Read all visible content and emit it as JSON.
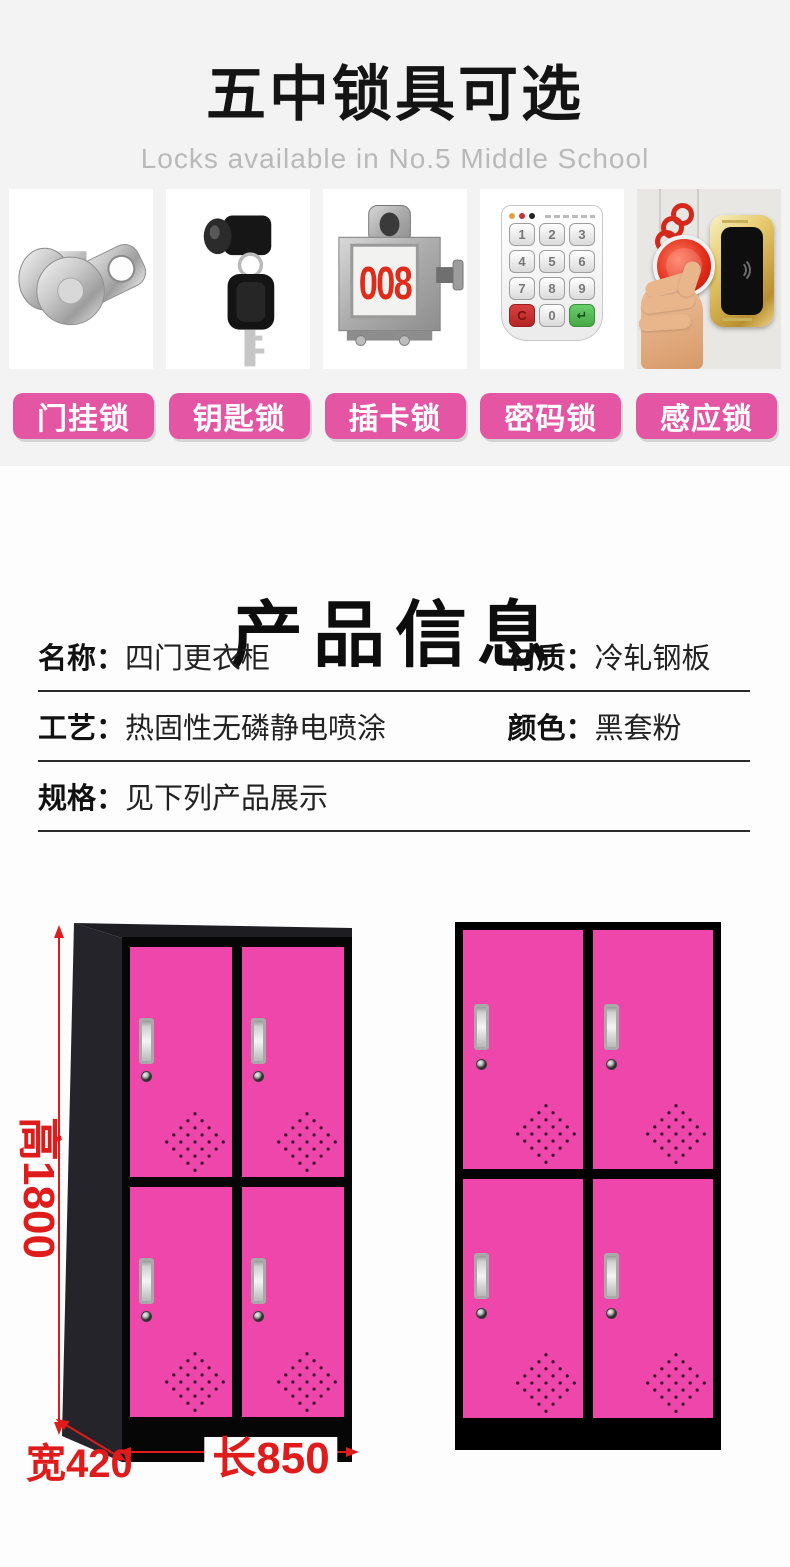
{
  "header": {
    "title": "五中锁具可选",
    "subtitle": "Locks available in No.5 Middle School"
  },
  "locks": {
    "buttons": [
      "门挂锁",
      "钥匙锁",
      "插卡锁",
      "密码锁",
      "感应锁"
    ],
    "card_display": "008",
    "keypad_keys": [
      "1",
      "2",
      "3",
      "4",
      "5",
      "6",
      "7",
      "8",
      "9",
      "C",
      "0",
      "↵"
    ]
  },
  "product_info": {
    "title": "产品信息",
    "rows": {
      "r1c1": {
        "label": "名称：",
        "value": "四门更衣柜"
      },
      "r1c2": {
        "label": "材质：",
        "value": "冷轧钢板"
      },
      "r2c1": {
        "label": "工艺：",
        "value": "热固性无磷静电喷涂"
      },
      "r2c2": {
        "label": "颜色：",
        "value": "黑套粉"
      },
      "r3c1": {
        "label": "规格：",
        "value": "见下列产品展示"
      }
    }
  },
  "dimensions": {
    "height": "高1800",
    "width": "宽420",
    "length": "长850"
  },
  "colors": {
    "accent_pink": "#e455a4",
    "locker_pink": "#ee46aa",
    "dimension_red": "#e01b1b",
    "top_background": "#f3f3f3"
  }
}
